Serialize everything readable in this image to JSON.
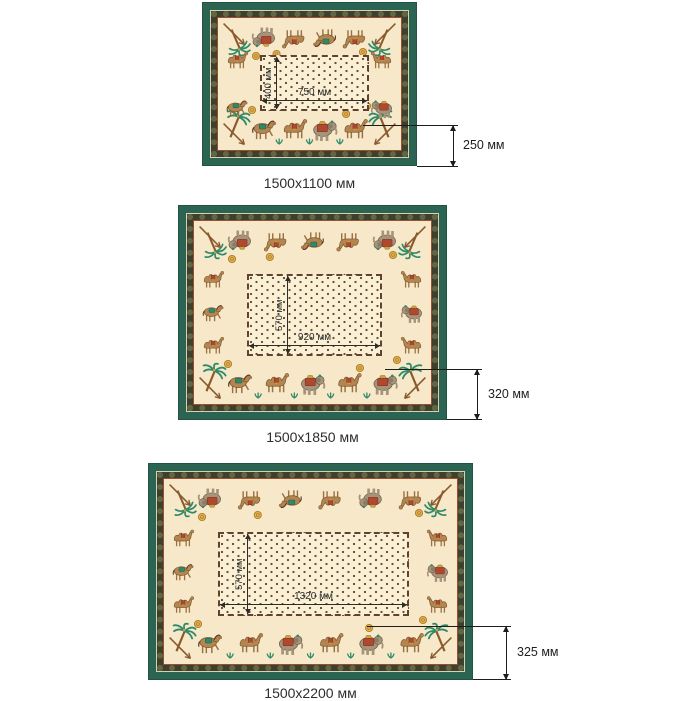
{
  "figure": "tablecloth size chart",
  "colors": {
    "border_green": "#2c6454",
    "band_dark": "#3d402d",
    "accent_red": "#9c4f2f",
    "field_cream": "#f6e8c9",
    "dot_brown": "#6a4c32",
    "dimension_line": "#1c1c1c",
    "palm_teal": "#2f8a6b",
    "gold": "#e3b04a"
  },
  "cloths": [
    {
      "size_label": "1500x1100 мм",
      "table_width": "750 мм",
      "table_height": "400 мм",
      "border_drop": "250 мм"
    },
    {
      "size_label": "1500x1850 мм",
      "table_width": "920 мм",
      "table_height": "570 мм",
      "border_drop": "320 мм"
    },
    {
      "size_label": "1500x2200 мм",
      "table_width": "1320 мм",
      "table_height": "570 мм",
      "border_drop": "325 мм"
    }
  ]
}
